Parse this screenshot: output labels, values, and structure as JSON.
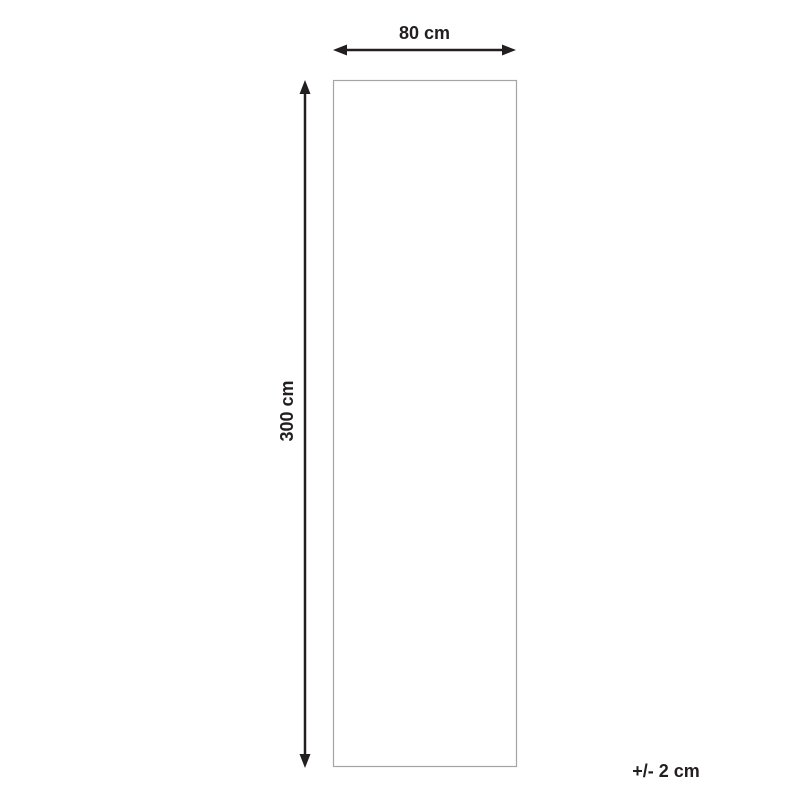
{
  "diagram": {
    "width_label": "80 cm",
    "height_label": "300 cm",
    "tolerance_label": "+/- 2 cm",
    "colors": {
      "arrow": "#231f20",
      "text": "#231f20",
      "outline": "#a4a4a4",
      "background": "#ffffff"
    }
  }
}
